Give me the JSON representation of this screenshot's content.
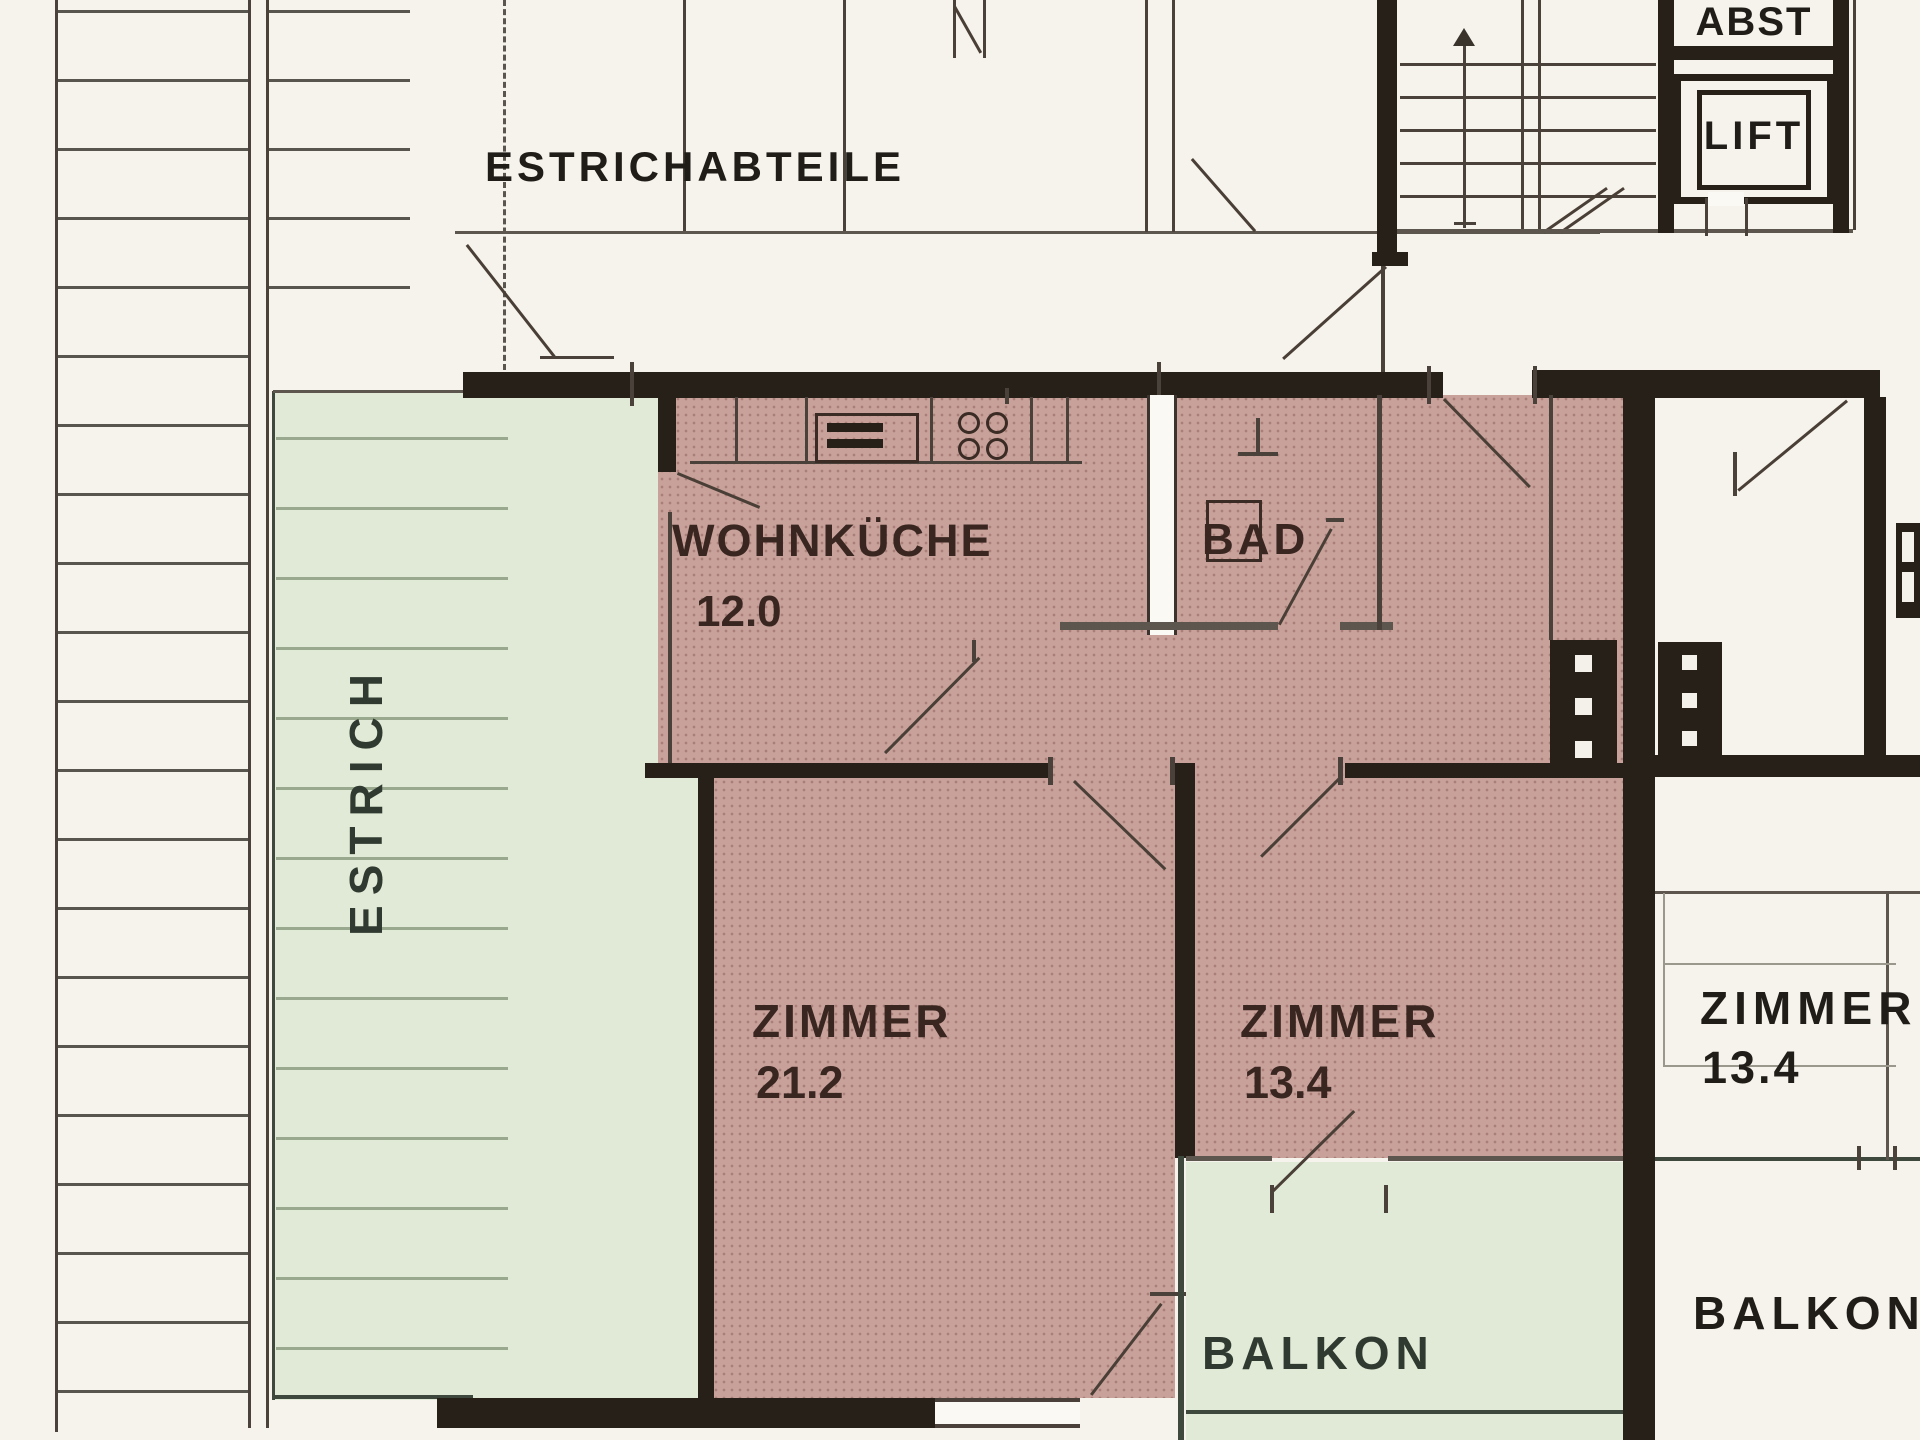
{
  "labels": {
    "attic_compartments": "ESTRICHABTEILE",
    "attic": "ESTRICH",
    "storage": "ABST",
    "lift": "LIFT",
    "balcony_left": "BALKON",
    "balcony_right": "BALKON"
  },
  "rooms": {
    "kitchen": {
      "name": "WOHNKÜCHE",
      "area": "12.0"
    },
    "bath": {
      "name": "BAD"
    },
    "bedroom_large": {
      "name": "ZIMMER",
      "area": "21.2"
    },
    "bedroom_small": {
      "name": "ZIMMER",
      "area": "13.4"
    },
    "neighbor_room": {
      "name": "ZIMMER",
      "area": "13.4"
    }
  },
  "colors": {
    "apartment_fill": "#c8a29a",
    "outdoor_fill": "#e0ead6",
    "wall": "#262019",
    "paper": "#f5f3ec"
  }
}
